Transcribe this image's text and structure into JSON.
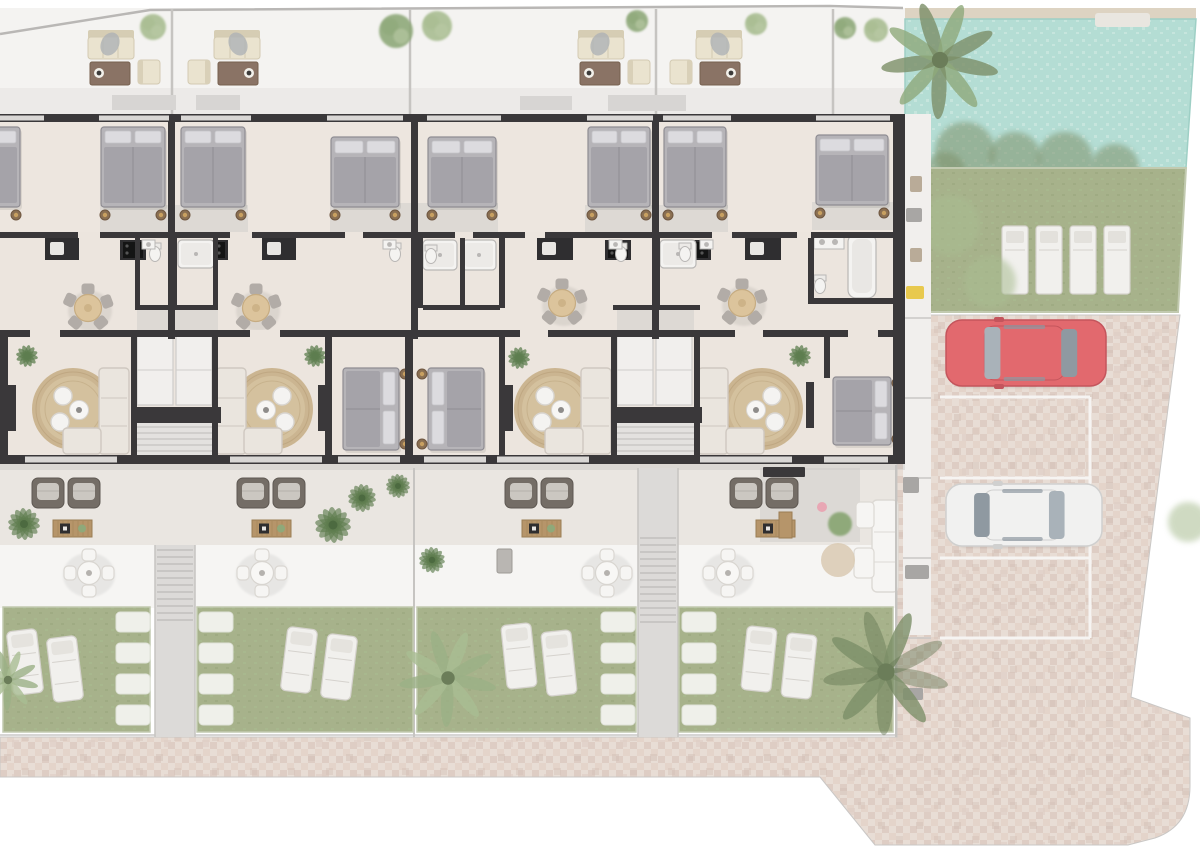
{
  "meta": {
    "description": "architectural-floor-plan-render",
    "visible_text": ""
  },
  "palette": {
    "page": "#ffffff",
    "roof": "#f4f3f1",
    "roofShade": "#eceae8",
    "floor": "#ece5de",
    "bedFloor": "#ede6df",
    "terraceBand": "#eae6e1",
    "patioBand": "#f6f5f3",
    "wall": "#3a383a",
    "windowGray": "#d9d7d5",
    "grayPath": "#cfcdcb",
    "fence": "#c6c4c1",
    "slab": "#d7d5d3",
    "rug": "#c9b28c",
    "rugLight": "#dbc9a6",
    "sofa": "#eae5de",
    "sofaEdge": "#cfc8c0",
    "bedBase": "#b6b4b8",
    "bedBlanket": "#a5a3a9",
    "bedPillow": "#dcdbdf",
    "bedEdge": "#8e8c92",
    "nightstand": "#8a6f52",
    "nightstandRing": "#c8a061",
    "tableBeige": "#dcc49c",
    "chairGray": "#b2aca7",
    "armBrown": "#746d66",
    "armCushion": "#cbc7c1",
    "wood": "#b6956a",
    "woodEdge": "#9b7d54",
    "plantDark": "#5e7d4f",
    "plantLight": "#8fa97a",
    "plantPale": "#a9bd92",
    "lawn": "#a7b28b",
    "hedge": "#7f916b",
    "pool": "#b4ddd4",
    "poolLight": "#c6e5dd",
    "poolDeck": "#ddd3c2",
    "brick1": "#e8ddd5",
    "brick2": "#decdc4",
    "brick3": "#e4d4ca",
    "brick4": "#d2bfb5",
    "stallLine": "#f6f4f2",
    "carRed": "#e2696e",
    "carRedDark": "#c4555c",
    "carWhite": "#f1f1f0",
    "carWhiteShade": "#d0d0cf",
    "glass": "#a9b2b9",
    "glassDark": "#8f99a1",
    "lounger": "#f1f0ed",
    "loungerEdge": "#d5d2cd",
    "stone": "#eff0ea",
    "stair": "#dcdad8",
    "stairLine": "#bcbab8",
    "cabinet": "#f1efed",
    "cabinetEdge": "#cfcdca",
    "fixtureEdge": "#b9b7b5",
    "cooktop": "#141414",
    "counterDark": "#2f2e30",
    "shadow": "#c9c7c5",
    "yellow": "#e8c94e",
    "pink": "#e8a7b4",
    "pouf": "#d9c9b2"
  },
  "scene": {
    "bands": {
      "roof": [
        0,
        8,
        905,
        106
      ],
      "roofShade": [
        0,
        88,
        905,
        26
      ],
      "building": [
        0,
        114,
        905,
        351
      ],
      "bedFloor": [
        0,
        114,
        905,
        118
      ],
      "terrace": [
        0,
        465,
        905,
        80
      ],
      "patio": [
        0,
        545,
        905,
        63
      ],
      "terraceShadow": [
        0,
        464,
        905,
        7
      ]
    },
    "boundary": [
      [
        0,
        34
      ],
      [
        150,
        10
      ],
      [
        830,
        6
      ],
      [
        903,
        8
      ]
    ],
    "fencesTop": [
      172,
      410,
      656,
      833
    ],
    "slabs": [
      [
        112,
        95,
        64,
        15
      ],
      [
        196,
        95,
        44,
        15
      ],
      [
        520,
        96,
        52,
        14
      ],
      [
        608,
        95,
        78,
        16
      ]
    ],
    "roofSets": [
      [
        88,
        0
      ],
      [
        186,
        1
      ],
      [
        578,
        0
      ],
      [
        668,
        1
      ]
    ],
    "topTrees": [
      [
        153,
        27,
        13,
        0
      ],
      [
        396,
        31,
        17,
        1
      ],
      [
        437,
        26,
        15,
        0
      ],
      [
        637,
        21,
        11,
        1
      ],
      [
        756,
        24,
        11,
        0
      ],
      [
        845,
        28,
        11,
        1
      ],
      [
        876,
        30,
        12,
        0
      ]
    ],
    "pool": {
      "deck": [
        905,
        8,
        291,
        11
      ],
      "water": [
        [
          905,
          19
        ],
        [
          1196,
          19
        ],
        [
          1186,
          168
        ],
        [
          905,
          168
        ]
      ],
      "steps": [
        1095,
        13,
        55,
        14
      ]
    },
    "poolHedge": [
      [
        965,
        152,
        30
      ],
      [
        1015,
        158,
        26
      ],
      [
        1065,
        160,
        28
      ],
      [
        1115,
        168,
        24
      ],
      [
        945,
        172,
        20
      ]
    ],
    "rightLawn": [
      [
        928,
        168
      ],
      [
        1186,
        168
      ],
      [
        1178,
        312
      ],
      [
        928,
        312
      ]
    ],
    "rightLoungers": [
      [
        1002,
        226
      ],
      [
        1036,
        226
      ],
      [
        1070,
        226
      ],
      [
        1104,
        226
      ]
    ],
    "rightTrees": [
      [
        950,
        225,
        30
      ],
      [
        990,
        282,
        26
      ],
      [
        1188,
        522,
        20
      ]
    ],
    "strip": {
      "rect": [
        903,
        114,
        28,
        521
      ],
      "dividers": [
        318,
        398,
        478,
        558,
        638
      ],
      "items": [
        [
          910,
          176,
          12,
          16,
          "c"
        ],
        [
          906,
          208,
          16,
          14,
          "d"
        ],
        [
          910,
          248,
          12,
          14,
          "c"
        ],
        [
          906,
          286,
          18,
          13,
          "y"
        ],
        [
          903,
          477,
          16,
          16,
          "d"
        ],
        [
          905,
          565,
          24,
          14,
          "d"
        ],
        [
          903,
          688,
          20,
          12,
          "d"
        ]
      ]
    },
    "brickOutline": "M0,737 L897,737 L897,315 L1180,315 L1131,697 L1190,718 L1190,786 Q1190,826 1155,838 L1128,845 L875,845 L820,777 L0,777 Z",
    "stallLines": {
      "h": [
        397,
        478,
        558,
        638
      ],
      "x1": 940,
      "x2": 1090
    },
    "cars": [
      {
        "x": 946,
        "y": 320,
        "w": 160,
        "h": 66,
        "front": "l",
        "body": "carRed",
        "shade": "carRedDark"
      },
      {
        "x": 946,
        "y": 484,
        "w": 156,
        "h": 62,
        "front": "r",
        "body": "carWhite",
        "shade": "carWhiteShade"
      }
    ],
    "grayRects": [
      [
        100,
        205,
        148,
        28
      ],
      [
        330,
        203,
        168,
        30
      ],
      [
        585,
        205,
        143,
        28
      ],
      [
        812,
        202,
        82,
        28
      ],
      [
        137,
        310,
        81,
        20
      ],
      [
        617,
        310,
        77,
        20
      ],
      [
        760,
        468,
        100,
        74
      ]
    ],
    "kitchens": {
      "counters": [
        [
          45,
          238,
          34
        ],
        [
          262,
          238,
          34
        ],
        [
          537,
          238,
          36
        ],
        [
          745,
          238,
          36
        ]
      ],
      "islands": [
        [
          120,
          240,
          26
        ],
        [
          202,
          240,
          26
        ],
        [
          605,
          240,
          26
        ],
        [
          685,
          240,
          26
        ]
      ]
    },
    "baths": {
      "showers": [
        [
          178,
          240,
          36,
          28
        ],
        [
          423,
          240,
          34,
          30
        ],
        [
          462,
          240,
          34,
          30
        ],
        [
          660,
          240,
          36,
          28
        ]
      ],
      "tubs": [
        [
          848,
          234,
          28,
          64
        ]
      ],
      "toilets": [
        [
          155,
          252
        ],
        [
          395,
          252
        ],
        [
          431,
          254
        ],
        [
          621,
          252
        ],
        [
          685,
          252
        ],
        [
          820,
          284
        ]
      ],
      "sinks": [
        [
          142,
          240
        ],
        [
          383,
          240
        ],
        [
          609,
          240
        ],
        [
          700,
          240
        ]
      ],
      "sinkCounters": [
        [
          814,
          236,
          30,
          13
        ]
      ]
    },
    "cores": [
      131,
      611
    ],
    "livings": [
      {
        "rug": [
          73,
          409
        ],
        "sofa": [
          99,
          368,
          0
        ],
        "tv": [
          8,
          385
        ],
        "plant": [
          27,
          356
        ]
      },
      {
        "rug": [
          272,
          409
        ],
        "sofa": [
          216,
          368,
          1
        ],
        "tv": [
          318,
          385
        ],
        "plant": [
          315,
          356
        ]
      },
      {
        "rug": [
          555,
          409
        ],
        "sofa": [
          581,
          368,
          0
        ],
        "tv": [
          505,
          385
        ],
        "plant": [
          519,
          358
        ]
      },
      {
        "rug": [
          762,
          409
        ],
        "sofa": [
          698,
          368,
          1
        ],
        "tv": [
          806,
          382
        ],
        "plant": [
          800,
          356
        ]
      }
    ],
    "dinings": [
      [
        88,
        308
      ],
      [
        256,
        308
      ],
      [
        562,
        303
      ],
      [
        742,
        303
      ]
    ],
    "topBeds": [
      [
        -44,
        127,
        64,
        80
      ],
      [
        101,
        127,
        64,
        80
      ],
      [
        181,
        127,
        64,
        80
      ],
      [
        331,
        137,
        68,
        70
      ],
      [
        428,
        137,
        68,
        70
      ],
      [
        588,
        127,
        62,
        80
      ],
      [
        664,
        127,
        62,
        80
      ],
      [
        816,
        135,
        72,
        70
      ]
    ],
    "midBeds": [
      [
        343,
        368,
        56,
        82,
        "r"
      ],
      [
        428,
        368,
        56,
        82,
        "l"
      ],
      [
        833,
        377,
        58,
        68,
        "r"
      ]
    ],
    "walls": {
      "h": [
        [
          0,
          114,
          905,
          8
        ],
        [
          0,
          232,
          905,
          6
        ],
        [
          0,
          330,
          905,
          7
        ],
        [
          0,
          455,
          905,
          9
        ],
        [
          135,
          305,
          83,
          5
        ],
        [
          423,
          305,
          77,
          5
        ],
        [
          613,
          305,
          87,
          5
        ],
        [
          808,
          298,
          87,
          6
        ],
        [
          131,
          407,
          90,
          16
        ],
        [
          611,
          407,
          91,
          16
        ]
      ],
      "v": [
        [
          168,
          114,
          7,
          225
        ],
        [
          411,
          114,
          7,
          225
        ],
        [
          652,
          114,
          7,
          225
        ],
        [
          893,
          114,
          12,
          350
        ],
        [
          131,
          330,
          6,
          133
        ],
        [
          212,
          330,
          6,
          133
        ],
        [
          611,
          330,
          6,
          133
        ],
        [
          694,
          330,
          6,
          133
        ],
        [
          325,
          330,
          7,
          133
        ],
        [
          405,
          330,
          8,
          133
        ],
        [
          499,
          330,
          6,
          133
        ],
        [
          0,
          330,
          8,
          133
        ],
        [
          824,
          330,
          6,
          48
        ],
        [
          172,
          237,
          5,
          71
        ],
        [
          655,
          237,
          5,
          71
        ],
        [
          417,
          237,
          6,
          71
        ],
        [
          460,
          237,
          5,
          71
        ],
        [
          499,
          237,
          6,
          71
        ],
        [
          135,
          237,
          5,
          71
        ],
        [
          213,
          237,
          5,
          71
        ],
        [
          808,
          232,
          6,
          72
        ]
      ],
      "windows": [
        [
          0,
          44
        ],
        [
          99,
          70
        ],
        [
          181,
          70
        ],
        [
          327,
          76
        ],
        [
          427,
          74
        ],
        [
          587,
          66
        ],
        [
          663,
          68
        ],
        [
          816,
          74
        ]
      ],
      "gaps232": [
        [
          78,
          22
        ],
        [
          230,
          22
        ],
        [
          345,
          18
        ],
        [
          455,
          18
        ],
        [
          525,
          20
        ],
        [
          712,
          20
        ],
        [
          797,
          14
        ]
      ],
      "gaps330": [
        [
          30,
          30
        ],
        [
          250,
          30
        ],
        [
          520,
          28
        ],
        [
          735,
          28
        ],
        [
          848,
          30
        ]
      ],
      "sills455": [
        [
          25,
          92
        ],
        [
          230,
          92
        ],
        [
          497,
          92
        ],
        [
          700,
          92
        ],
        [
          824,
          64
        ],
        [
          338,
          62
        ],
        [
          424,
          62
        ]
      ]
    },
    "terraceChairs": [
      [
        32,
        478
      ],
      [
        68,
        478
      ],
      [
        237,
        478
      ],
      [
        273,
        478
      ],
      [
        505,
        478
      ],
      [
        541,
        478
      ],
      [
        730,
        478
      ],
      [
        766,
        478
      ]
    ],
    "woodTables": [
      [
        53,
        520
      ],
      [
        252,
        520
      ],
      [
        522,
        520
      ],
      [
        756,
        520
      ]
    ],
    "patioSets": [
      [
        89,
        573
      ],
      [
        262,
        573
      ],
      [
        607,
        573
      ],
      [
        728,
        573
      ]
    ],
    "grill": [
      497,
      549,
      15,
      24
    ],
    "endTerrace": {
      "bench": [
        763,
        467,
        42,
        10
      ],
      "woodBench": [
        779,
        512,
        13,
        26
      ],
      "pot": [
        822,
        507,
        5
      ],
      "sofaV": [
        872,
        500,
        26,
        92
      ],
      "chaiseTop": [
        856,
        502,
        18,
        26
      ],
      "chaiseBottom": [
        854,
        548,
        20,
        30
      ],
      "pouf": [
        838,
        560,
        17
      ],
      "bush": [
        840,
        524,
        12
      ]
    },
    "gardenStairs": [
      {
        "rect": [
          155,
          545,
          40,
          192
        ],
        "steps": [
          550,
          624
        ]
      },
      {
        "rect": [
          638,
          468,
          40,
          269
        ],
        "steps": [
          538,
          628
        ]
      }
    ],
    "fences": [
      [
        414,
        468,
        737
      ],
      [
        896,
        465,
        737
      ]
    ],
    "lawns": [
      [
        3,
        607,
        147,
        125
      ],
      [
        197,
        607,
        216,
        125
      ],
      [
        417,
        607,
        219,
        125
      ],
      [
        679,
        607,
        214,
        125
      ]
    ],
    "stones": {
      "cols": [
        116,
        199,
        601,
        682
      ],
      "ys": [
        612,
        643,
        674,
        705
      ]
    },
    "gLoungers": [
      [
        10,
        630,
        -7
      ],
      [
        50,
        637,
        -7
      ],
      [
        284,
        628,
        7
      ],
      [
        324,
        635,
        7
      ],
      [
        504,
        624,
        -6
      ],
      [
        544,
        631,
        -6
      ],
      [
        744,
        627,
        6
      ],
      [
        784,
        634,
        6
      ]
    ],
    "gardenPlants": [
      [
        24,
        524,
        16
      ],
      [
        333,
        525,
        18
      ],
      [
        362,
        498,
        14
      ],
      [
        398,
        486,
        12
      ],
      [
        432,
        560,
        13
      ]
    ],
    "palms": [
      {
        "c": [
          940,
          60
        ],
        "r": 58,
        "tone": 0
      },
      {
        "c": [
          886,
          672
        ],
        "r": 62,
        "tone": 1
      },
      {
        "c": [
          448,
          678
        ],
        "r": 48,
        "tone": 2
      },
      {
        "c": [
          8,
          680
        ],
        "r": 30,
        "tone": 2
      }
    ],
    "pathLine": [
      0,
      735,
      897,
      735
    ]
  }
}
